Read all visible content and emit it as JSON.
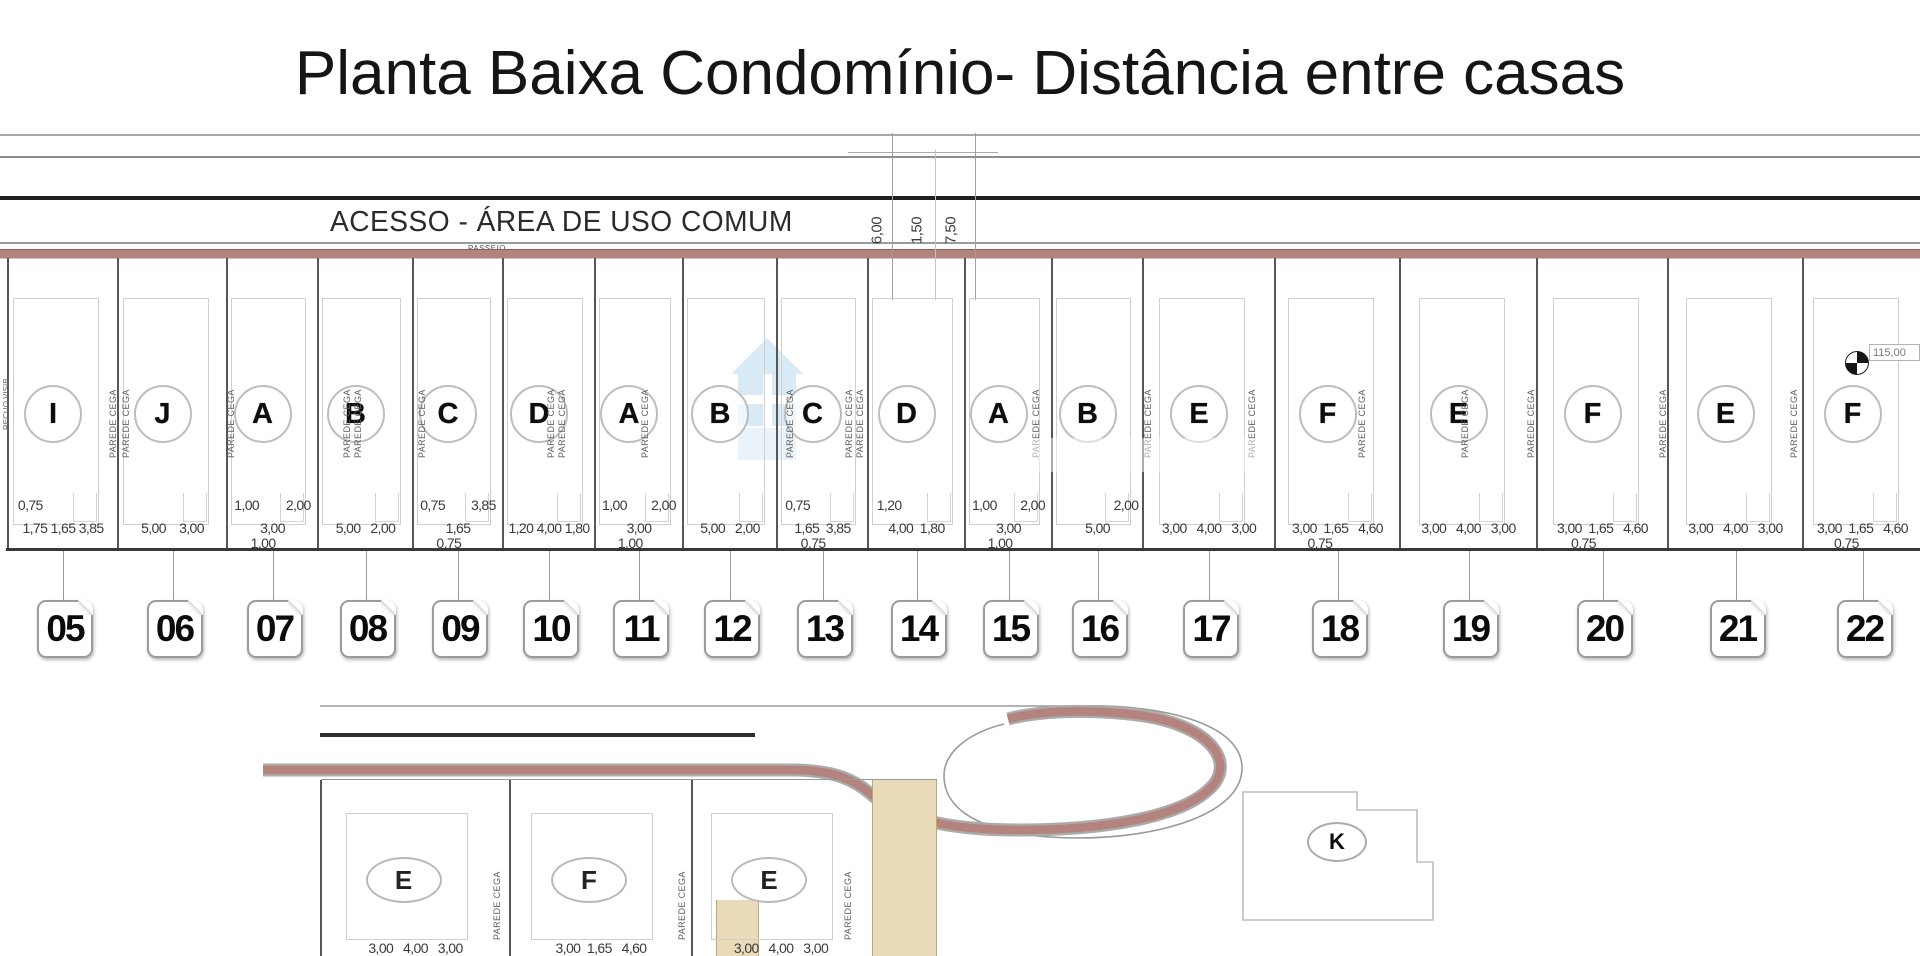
{
  "title": "Planta Baixa Condomínio- Distância entre casas",
  "top_strip": {
    "access_label": "ACESSO - ÁREA DE USO COMUM",
    "sidewalk_label": "PASSEIO",
    "vertical_dims": [
      {
        "value": "6,00",
        "x": 877
      },
      {
        "value": "1,50",
        "x": 917
      },
      {
        "value": "7,50",
        "x": 951
      }
    ]
  },
  "survey_marker": {
    "label": "115,00"
  },
  "wall_label_text": "PAREDE CEGA",
  "corner_label_text": "RECUO VISIB.",
  "lots": [
    {
      "number": "05",
      "letter": "I",
      "x1": 8,
      "x2": 118,
      "dims_top": {
        "mode": "left",
        "values": [
          "0,75"
        ]
      },
      "dims_main": "1,75 1,65 3,85",
      "dims_sub": ""
    },
    {
      "number": "06",
      "letter": "J",
      "x1": 118,
      "x2": 227,
      "dims_main": "5,00    3,00"
    },
    {
      "number": "07",
      "letter": "A",
      "x1": 227,
      "x2": 318,
      "dims_top": {
        "mode": "split",
        "values": [
          "1,00",
          "2,00"
        ]
      },
      "dims_main": "3,00",
      "dims_sub": "1,00"
    },
    {
      "number": "08",
      "letter": "B",
      "x1": 318,
      "x2": 413,
      "dims_main": "5,00   2,00"
    },
    {
      "number": "09",
      "letter": "C",
      "x1": 413,
      "x2": 503,
      "dims_top": {
        "mode": "split",
        "values": [
          "0,75",
          "3,85"
        ]
      },
      "dims_main": "1,65",
      "dims_sub": "0,75"
    },
    {
      "number": "10",
      "letter": "D",
      "x1": 503,
      "x2": 595,
      "dims_main": "1,20 4,00 1,80"
    },
    {
      "number": "11",
      "letter": "A",
      "x1": 595,
      "x2": 683,
      "dims_top": {
        "mode": "split",
        "values": [
          "1,00",
          "2,00"
        ]
      },
      "dims_main": "3,00",
      "dims_sub": "1,00"
    },
    {
      "number": "12",
      "letter": "B",
      "x1": 683,
      "x2": 777,
      "dims_main": "5,00   2,00"
    },
    {
      "number": "13",
      "letter": "C",
      "x1": 777,
      "x2": 868,
      "dims_top": {
        "mode": "left",
        "values": [
          "0,75"
        ]
      },
      "dims_main": "1,65  3,85",
      "dims_sub": "0,75"
    },
    {
      "number": "14",
      "letter": "D",
      "x1": 868,
      "x2": 965,
      "dims_top": {
        "mode": "left",
        "values": [
          "1,20"
        ]
      },
      "dims_main": "4,00  1,80"
    },
    {
      "number": "15",
      "letter": "A",
      "x1": 965,
      "x2": 1052,
      "dims_top": {
        "mode": "split",
        "values": [
          "1,00",
          "2,00"
        ]
      },
      "dims_main": "3,00",
      "dims_sub": "1,00"
    },
    {
      "number": "16",
      "letter": "B",
      "x1": 1052,
      "x2": 1143,
      "dims_top": {
        "mode": "right",
        "values": [
          "2,00"
        ]
      },
      "dims_main": "5,00"
    },
    {
      "number": "17",
      "letter": "E",
      "x1": 1143,
      "x2": 1275,
      "dims_main": "3,00   4,00   3,00"
    },
    {
      "number": "18",
      "letter": "F",
      "x1": 1275,
      "x2": 1400,
      "dims_main": "3,00  1,65   4,60",
      "dims_sub": "0,75"
    },
    {
      "number": "19",
      "letter": "E",
      "x1": 1400,
      "x2": 1537,
      "dims_main": "3,00   4,00   3,00"
    },
    {
      "number": "20",
      "letter": "F",
      "x1": 1537,
      "x2": 1668,
      "dims_main": "3,00  1,65   4,60",
      "dims_sub": "0,75"
    },
    {
      "number": "21",
      "letter": "E",
      "x1": 1668,
      "x2": 1803,
      "dims_main": "3,00   4,00   3,00"
    },
    {
      "number": "22",
      "letter": "F",
      "x1": 1803,
      "x2": 1922,
      "dims_main": "3,00  1,65   4,60",
      "dims_sub": "0,75"
    }
  ],
  "wall_labels_top_x": [
    113,
    126,
    231,
    347,
    358,
    422,
    551,
    562,
    645,
    790,
    849,
    860,
    1036,
    1148,
    1252,
    1362,
    1465,
    1531,
    1663,
    1794
  ],
  "bottom_section": {
    "lots": [
      {
        "letter": "E",
        "x1": 321,
        "x2": 510,
        "dims_main": "3,00   4,00   3,00"
      },
      {
        "letter": "F",
        "x1": 510,
        "x2": 692,
        "dims_main": "3,00  1,65   4,60"
      },
      {
        "letter": "E",
        "x1": 692,
        "x2": 870,
        "dims_main": "3,00   4,00   3,00"
      }
    ],
    "wall_labels_x": [
      497,
      682,
      848
    ],
    "k_lot_letter": "K"
  },
  "colors": {
    "road_red": "#b5837d",
    "wall_beige": "#e9dab8",
    "line_dark": "#2e2e2e",
    "line_gray": "#9a9a9a",
    "watermark_blue": "#badaf0"
  }
}
